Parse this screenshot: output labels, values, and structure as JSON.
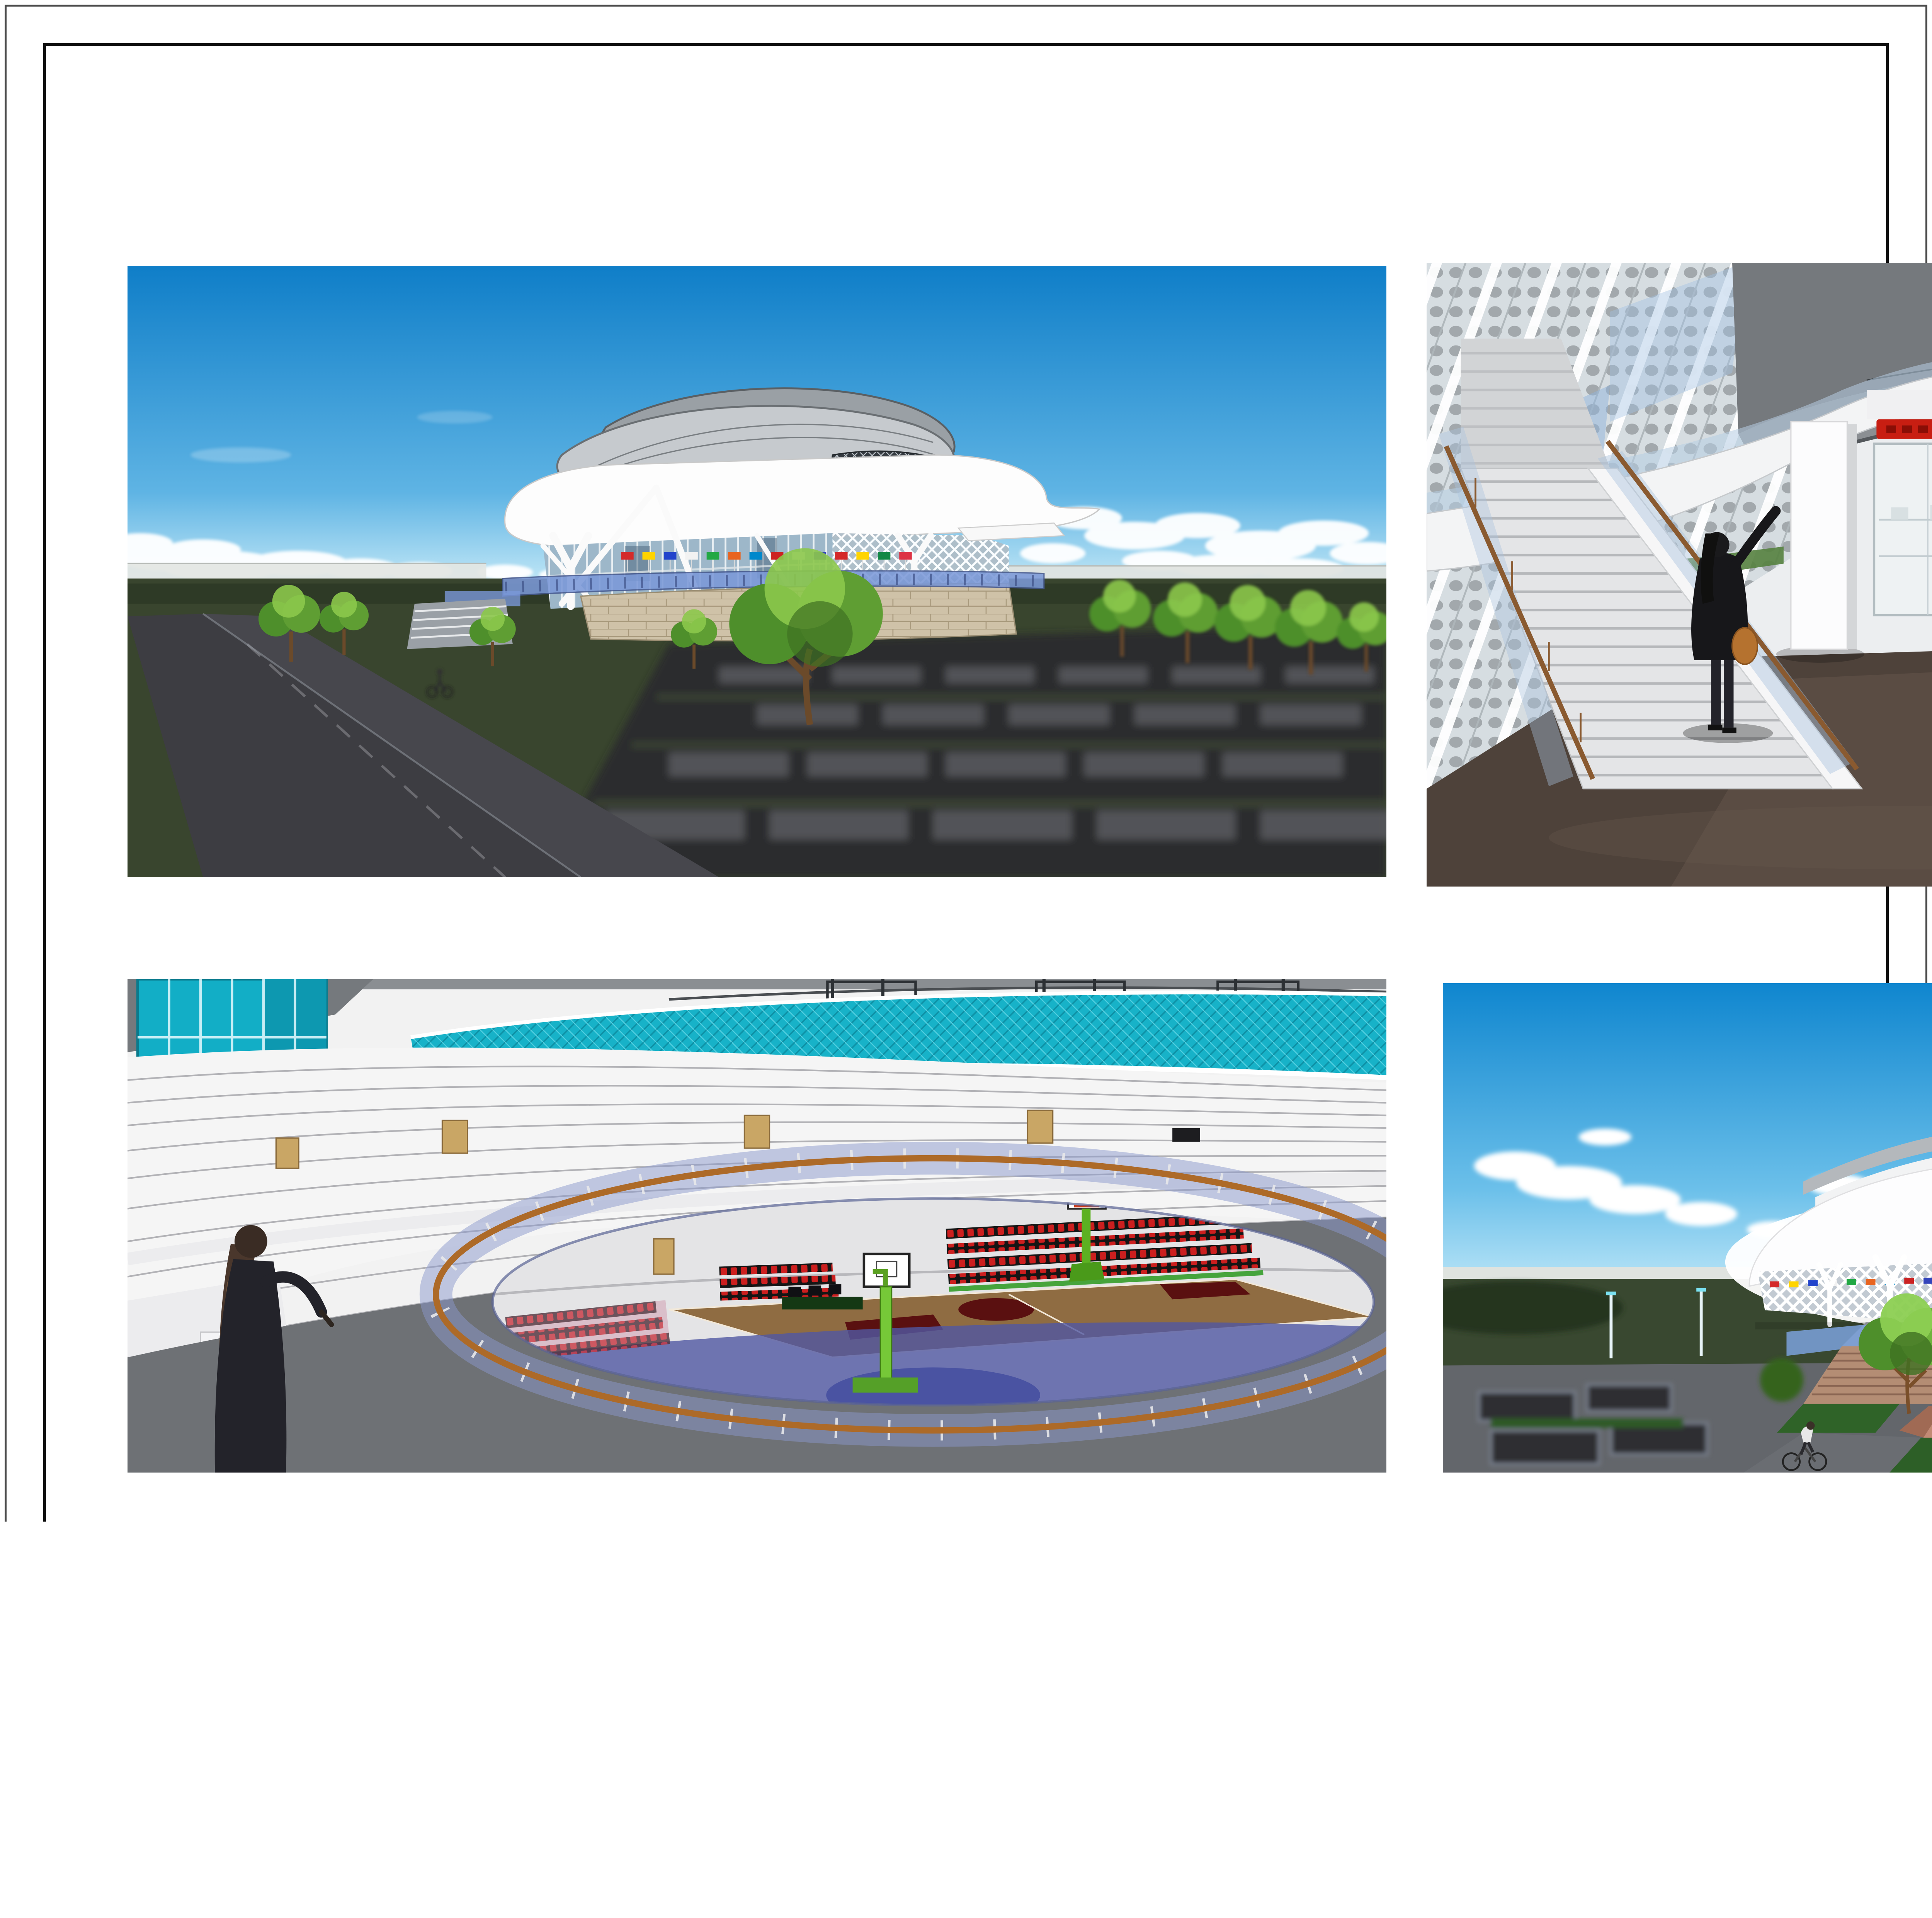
{
  "sheet": {
    "background": "#ffffff",
    "outer_border_color": "#4a4a4a",
    "inner_border_color": "#0d0d0d"
  },
  "renders": {
    "top_left_label": "exterior side perspective render",
    "top_right_label": "interior lobby perspective render",
    "bottom_left_label": "interior arena bowl perspective render",
    "bottom_right_label": "exterior front entrance perspective render"
  },
  "signage": {
    "arena_name": "GARUDA ARENA",
    "storefront_sign": "adidas"
  },
  "palette": {
    "sky_blue": "#1583cc",
    "grass_green": "#394830",
    "road_gray": "#3b3b40",
    "accent_red": "#e8231a",
    "teal_glass": "#17b2c8",
    "railing_blue": "#7b99d8",
    "floor_brown": "#4e4239",
    "wood_tan": "#b5793a",
    "fountain_cyan": "#35d0ea"
  },
  "title_block": {
    "header": "TUGAS AKHIR - SEMESTER GENAP 2014/2015",
    "judul_tugas": {
      "label": "JUDUL TUGAS",
      "line1": "ARENA BOLA BASKET DI",
      "line2": "TANGERANG SELATAN"
    },
    "judul_gambar": {
      "label": "JUDUL GAMBAR",
      "value": "PERSPEKTIF"
    },
    "skala": {
      "label": "SKALA",
      "value": ""
    },
    "nama": {
      "label": "NAMA",
      "value": "SARIPUTRA ARIF WICAKSANA"
    },
    "nrp": {
      "label": "NRP",
      "value": "22411142"
    },
    "kelompok": {
      "label": "KELOMPOK",
      "value": "5"
    },
    "mentor_utama": {
      "label": "MENTOR UTAMA",
      "value": "IR.BISATYA W MAER, MT"
    },
    "mentor_pendamping": {
      "label": "MENTOR PENDAMPING",
      "value1": "IR. IRWAN SANTOSO, MT.",
      "value2": "IR. HANDINOTO, MT."
    },
    "lembar": {
      "label": "LEMBAR",
      "value": ""
    },
    "jumlah": {
      "label": "JUMLAH",
      "value": ""
    },
    "institution": {
      "seal_text_top": "UNIVERSITAS KRISTEN",
      "seal_text_bottom": "PETRA",
      "line1": "PROGRAM STUDI ARSITEKTUR",
      "line2": "FAKULTAS TEKNIK SIPIL DAN PERENCANAAN",
      "line3": "UNIVERSITAS KRISTEN PETRA",
      "line4": "SURABAYA"
    }
  }
}
